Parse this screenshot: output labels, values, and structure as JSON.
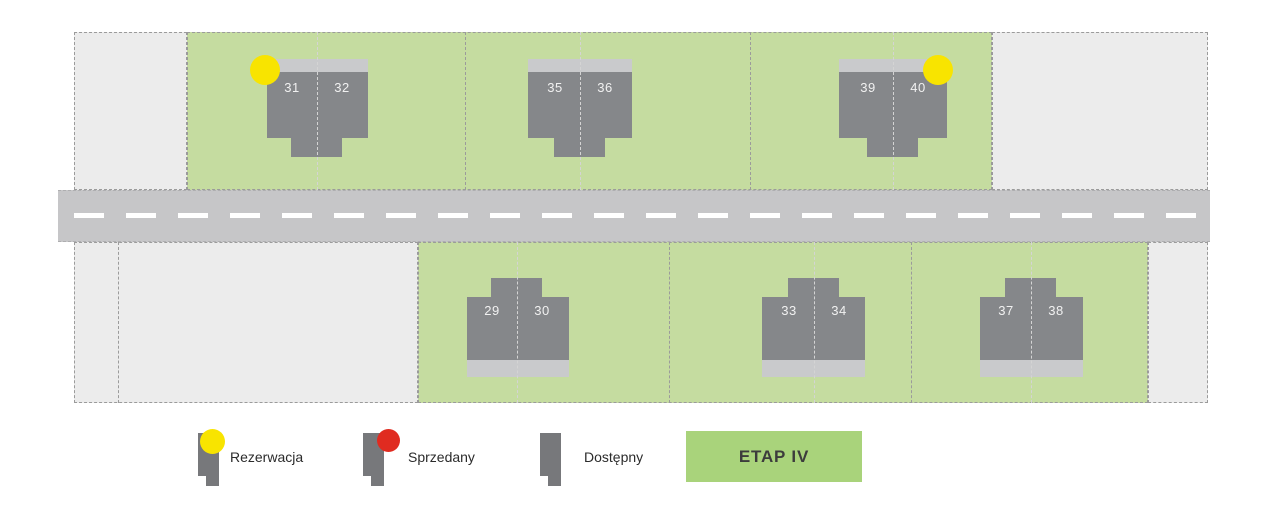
{
  "stage": {
    "label": "ETAP IV",
    "color": "#a9d37b"
  },
  "legend": [
    {
      "key": "rezerwacja",
      "label": "Rezerwacja",
      "icon": "house-icon",
      "marker_color": "#f8e400"
    },
    {
      "key": "sprzedany",
      "label": "Sprzedany",
      "icon": "house-icon",
      "marker_color": "#e02b20"
    },
    {
      "key": "dostepny",
      "label": "Dostępny",
      "icon": "house-icon",
      "marker_color": null
    }
  ],
  "units": [
    {
      "number": "29",
      "status": "dostepny"
    },
    {
      "number": "30",
      "status": "dostepny"
    },
    {
      "number": "31",
      "status": "rezerwacja"
    },
    {
      "number": "32",
      "status": "dostepny"
    },
    {
      "number": "33",
      "status": "dostepny"
    },
    {
      "number": "34",
      "status": "dostepny"
    },
    {
      "number": "35",
      "status": "dostepny"
    },
    {
      "number": "36",
      "status": "dostepny"
    },
    {
      "number": "37",
      "status": "dostepny"
    },
    {
      "number": "38",
      "status": "dostepny"
    },
    {
      "number": "39",
      "status": "dostepny"
    },
    {
      "number": "40",
      "status": "rezerwacja"
    }
  ],
  "colors": {
    "plot_green": "#c5dca0",
    "plot_gray": "#ececec",
    "road": "#c6c6c8",
    "road_line": "#ffffff",
    "house_dark": "#85878a",
    "house_light": "#c9cacc",
    "boundary_dash": "#9b9b9b",
    "inner_dash": "#d4d4d4",
    "reserved_yellow": "#f8e400",
    "sold_red": "#e02b20",
    "stage_green": "#a9d37b",
    "text_dark": "#2b2b2b",
    "house_number_text": "#f1f1f1"
  }
}
